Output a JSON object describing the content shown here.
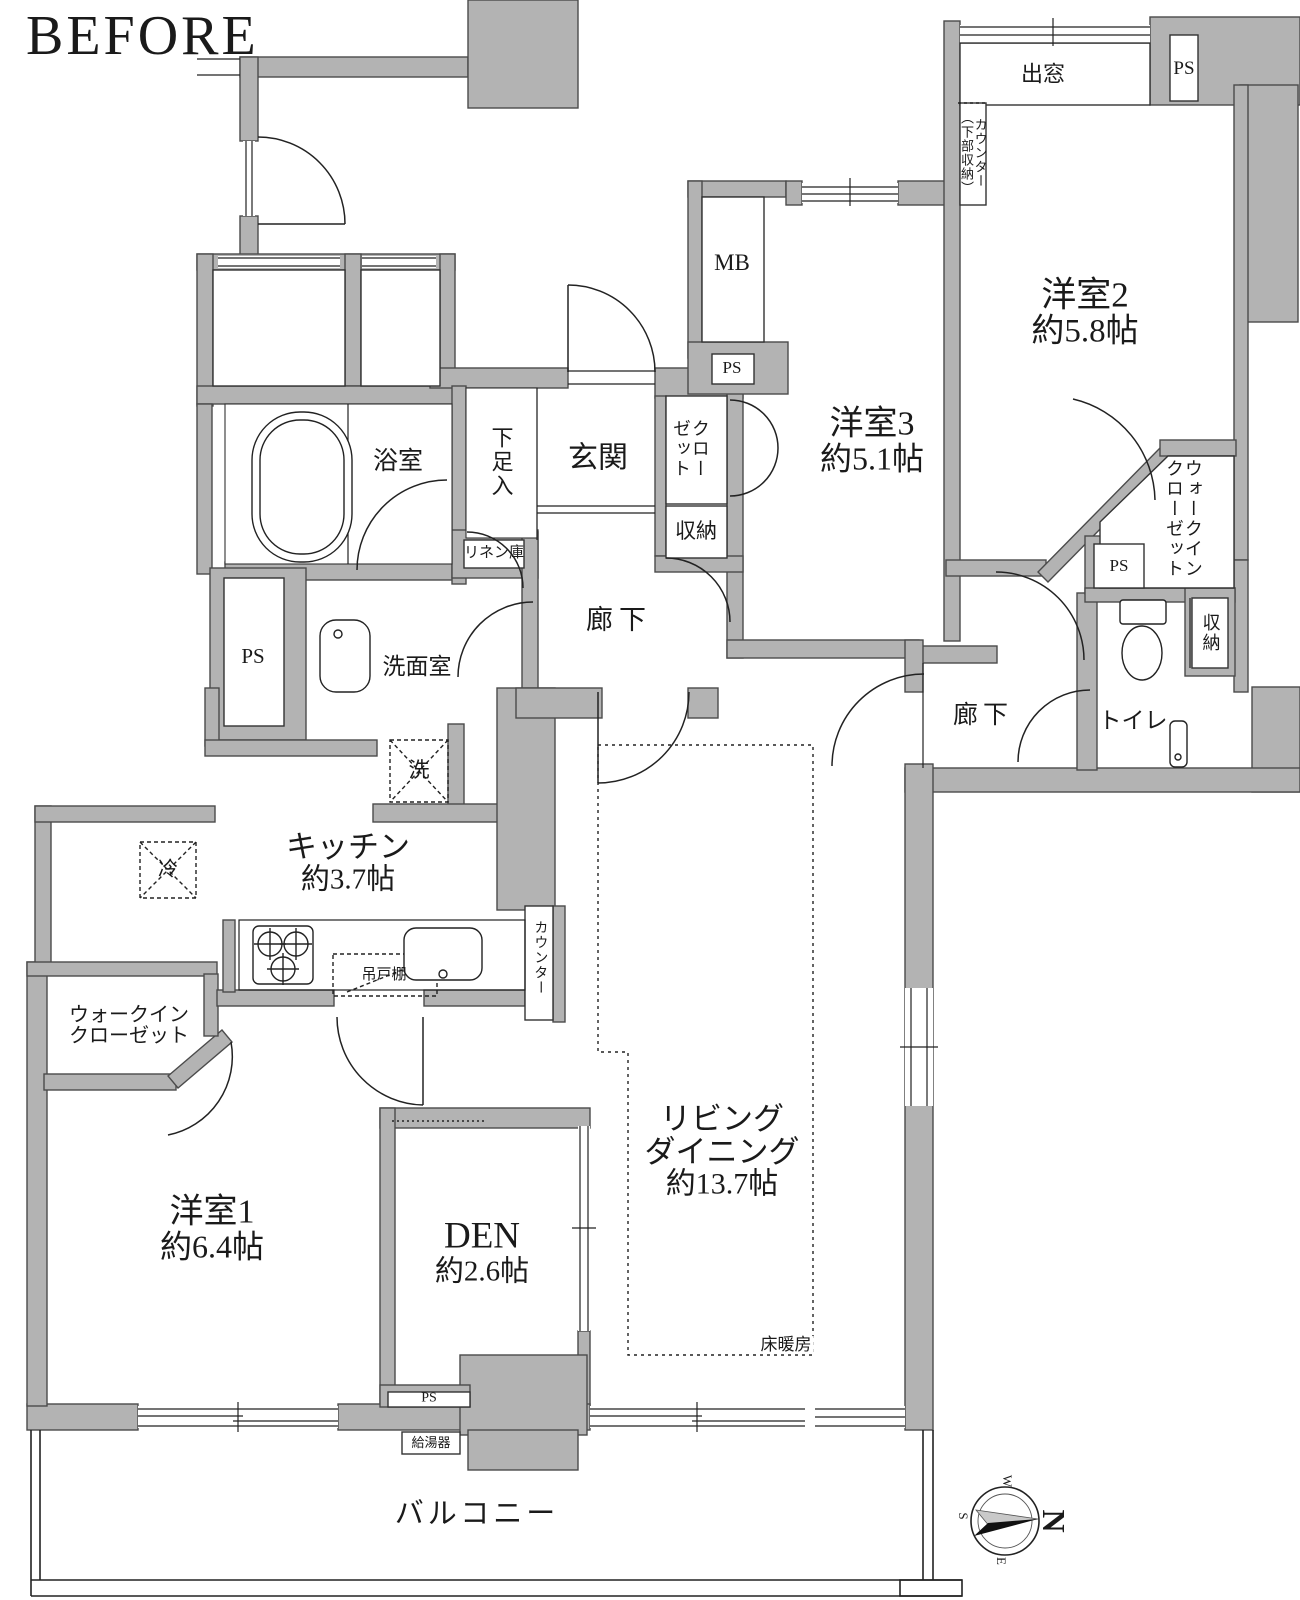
{
  "title": "BEFORE",
  "colors": {
    "wall_fill": "#b3b3b3",
    "wall_stroke": "#4b4b4b",
    "line": "#1a1a1a"
  },
  "labels": {
    "bay_window": "出窓",
    "ps": "PS",
    "counter_storage": "カウンター（下部収納）",
    "room2_name": "洋室2",
    "room2_size": "約5.8帖",
    "room3_name": "洋室3",
    "room3_size": "約5.1帖",
    "room1_name": "洋室1",
    "room1_size": "約6.4帖",
    "den_name": "DEN",
    "den_size": "約2.6帖",
    "kitchen_name": "キッチン",
    "kitchen_size": "約3.7帖",
    "living_line1": "リビング",
    "living_line2": "ダイニング",
    "living_size": "約13.7帖",
    "mb": "MB",
    "closet": "クローゼット",
    "storage": "収納",
    "genkan": "玄関",
    "shoe_box": "下足入",
    "bath": "浴室",
    "linen": "リネン庫",
    "corridor": "廊下",
    "washroom": "洗面室",
    "washer": "洗",
    "fridge": "冷",
    "hanging_cabinet": "吊戸棚",
    "counter": "カウンター",
    "wic": "ウォークインクローゼット",
    "wic_line1": "ウォークイン",
    "wic_line2": "クローゼット",
    "toilet": "トイレ",
    "floor_heating": "床暖房",
    "water_heater": "給湯器",
    "balcony": "バルコニー"
  },
  "compass": {
    "n": "N",
    "e": "E",
    "s": "S",
    "w": "W"
  }
}
